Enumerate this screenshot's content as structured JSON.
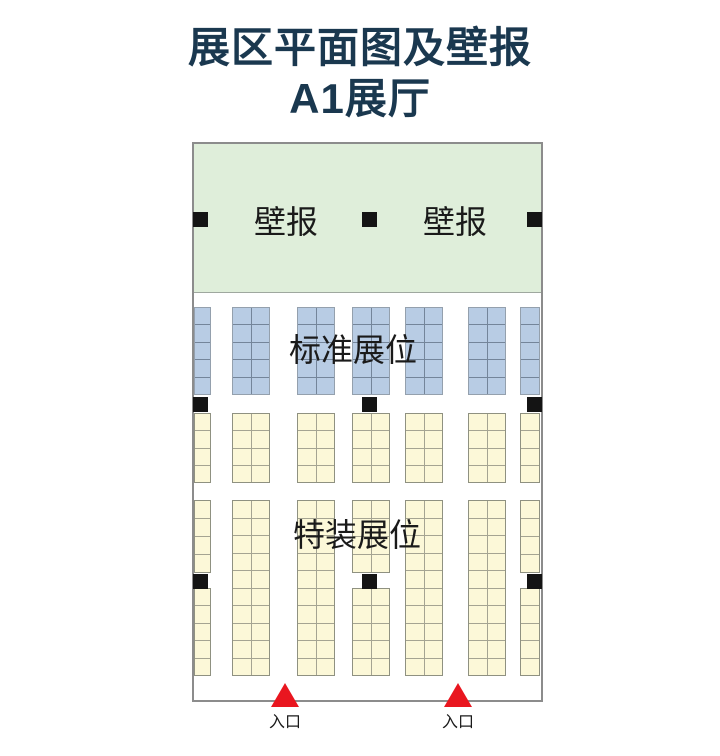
{
  "title": {
    "line1": "展区平面图及壁报",
    "line2": "A1展厅"
  },
  "plan": {
    "poster_zone": {
      "label_left": "壁报",
      "label_right": "壁报"
    },
    "standard_zone_label": "标准展位",
    "special_zone_label": "特装展位",
    "blocks": [
      {
        "kind": "standard",
        "x": 2,
        "y": 165,
        "w": 17,
        "h": 88,
        "cols": 1,
        "rows": 5
      },
      {
        "kind": "standard",
        "x": 40,
        "y": 165,
        "w": 38,
        "h": 88,
        "cols": 2,
        "rows": 5
      },
      {
        "kind": "standard",
        "x": 105,
        "y": 165,
        "w": 38,
        "h": 88,
        "cols": 2,
        "rows": 5
      },
      {
        "kind": "standard",
        "x": 160,
        "y": 165,
        "w": 38,
        "h": 88,
        "cols": 2,
        "rows": 5
      },
      {
        "kind": "standard",
        "x": 213,
        "y": 165,
        "w": 38,
        "h": 88,
        "cols": 2,
        "rows": 5
      },
      {
        "kind": "standard",
        "x": 276,
        "y": 165,
        "w": 38,
        "h": 88,
        "cols": 2,
        "rows": 5
      },
      {
        "kind": "standard",
        "x": 328,
        "y": 165,
        "w": 20,
        "h": 88,
        "cols": 1,
        "rows": 5
      },
      {
        "kind": "special",
        "x": 2,
        "y": 271,
        "w": 17,
        "h": 70,
        "cols": 1,
        "rows": 4
      },
      {
        "kind": "special",
        "x": 40,
        "y": 271,
        "w": 38,
        "h": 70,
        "cols": 2,
        "rows": 4
      },
      {
        "kind": "special",
        "x": 105,
        "y": 271,
        "w": 38,
        "h": 70,
        "cols": 2,
        "rows": 4
      },
      {
        "kind": "special",
        "x": 160,
        "y": 271,
        "w": 38,
        "h": 70,
        "cols": 2,
        "rows": 4
      },
      {
        "kind": "special",
        "x": 213,
        "y": 271,
        "w": 38,
        "h": 70,
        "cols": 2,
        "rows": 4
      },
      {
        "kind": "special",
        "x": 276,
        "y": 271,
        "w": 38,
        "h": 70,
        "cols": 2,
        "rows": 4
      },
      {
        "kind": "special",
        "x": 328,
        "y": 271,
        "w": 20,
        "h": 70,
        "cols": 1,
        "rows": 4
      },
      {
        "kind": "special",
        "x": 40,
        "y": 358,
        "w": 38,
        "h": 176,
        "cols": 2,
        "rows": 10
      },
      {
        "kind": "special",
        "x": 105,
        "y": 358,
        "w": 38,
        "h": 176,
        "cols": 2,
        "rows": 10
      },
      {
        "kind": "special",
        "x": 213,
        "y": 358,
        "w": 38,
        "h": 176,
        "cols": 2,
        "rows": 10
      },
      {
        "kind": "special",
        "x": 276,
        "y": 358,
        "w": 38,
        "h": 176,
        "cols": 2,
        "rows": 10
      },
      {
        "kind": "special",
        "x": 2,
        "y": 358,
        "w": 17,
        "h": 73,
        "cols": 1,
        "rows": 4
      },
      {
        "kind": "special",
        "x": 160,
        "y": 358,
        "w": 38,
        "h": 73,
        "cols": 2,
        "rows": 4
      },
      {
        "kind": "special",
        "x": 328,
        "y": 358,
        "w": 20,
        "h": 73,
        "cols": 1,
        "rows": 4
      },
      {
        "kind": "special",
        "x": 2,
        "y": 446,
        "w": 17,
        "h": 88,
        "cols": 1,
        "rows": 5
      },
      {
        "kind": "special",
        "x": 160,
        "y": 446,
        "w": 38,
        "h": 88,
        "cols": 2,
        "rows": 5
      },
      {
        "kind": "special",
        "x": 328,
        "y": 446,
        "w": 20,
        "h": 88,
        "cols": 1,
        "rows": 5
      }
    ],
    "pillars": [
      {
        "x": 1,
        "y": 70
      },
      {
        "x": 170,
        "y": 70
      },
      {
        "x": 335,
        "y": 70
      },
      {
        "x": 1,
        "y": 255
      },
      {
        "x": 170,
        "y": 255
      },
      {
        "x": 335,
        "y": 255
      },
      {
        "x": 1,
        "y": 432
      },
      {
        "x": 170,
        "y": 432
      },
      {
        "x": 335,
        "y": 432
      }
    ],
    "entrances": [
      {
        "label": "入口",
        "triangle_left": 79,
        "label_center": 93
      },
      {
        "label": "入口",
        "triangle_left": 252,
        "label_center": 266
      }
    ]
  },
  "colors": {
    "title": "#1a384f",
    "label_text": "#1a1a1a",
    "wall": "#8c8c8c",
    "poster_zone_bg": "#dfeeda",
    "poster_zone_border": "#9fa89f",
    "standard_cell": "#b8cce4",
    "standard_line": "#74859a",
    "standard_outline": "#94a0ad",
    "special_cell": "#fcf8d8",
    "special_line": "#a5a492",
    "special_outline": "#8f9181",
    "pillar": "#141414",
    "entrance": "#e9161f"
  }
}
